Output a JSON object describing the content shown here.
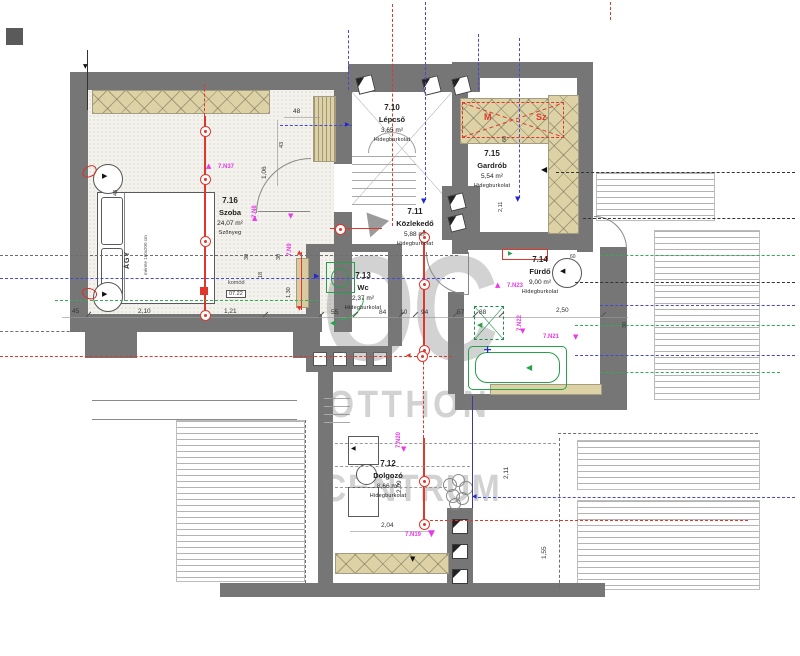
{
  "rooms": [
    {
      "num": "7.10",
      "name": "Lépcső",
      "area": "3,65 m²",
      "floor": "Hidegburkolat"
    },
    {
      "num": "7.11",
      "name": "Közlekedő",
      "area": "5,88 m²",
      "floor": "Hidegburkolat"
    },
    {
      "num": "7.12",
      "name": "Dolgozó",
      "area": "8,66 m²",
      "floor": "Hidegburkolat"
    },
    {
      "num": "7.13",
      "name": "Wc",
      "area": "2,37 m²",
      "floor": "Hidegburkolat"
    },
    {
      "num": "7.14",
      "name": "Fürdő",
      "area": "9,00 m²",
      "floor": "Hidegburkolat"
    },
    {
      "num": "7.15",
      "name": "Gardrób",
      "area": "5,54 m²",
      "floor": "Hidegburkolat"
    },
    {
      "num": "7.16",
      "name": "Szoba",
      "area": "24,07 m²",
      "floor": "Szőnyeg"
    }
  ],
  "furniture": {
    "bed": "ÁGY",
    "bed_size": "mérete 160x200 cm",
    "komod": "komód",
    "komod_code": "07.22"
  },
  "flags": {
    "m": "M",
    "sz": "Sz"
  },
  "markers": [
    "7.N37",
    "7.N8",
    "7.N9",
    "7.N23",
    "7.N22",
    "7.N21",
    "7.N20",
    "7.N19"
  ],
  "dims": [
    "48",
    "1,06",
    "43",
    "43",
    "45",
    "2,10",
    "1,21",
    "30",
    "30",
    "18",
    "1,30",
    "55",
    "84",
    "10",
    "94",
    "57",
    "88",
    "2,50",
    "30",
    "60",
    "60",
    "2,04",
    "2,09",
    "2,11",
    "1,55",
    "2,11"
  ],
  "watermark": {
    "line1": "OC",
    "line2": "OTTHON",
    "line3": "CENTRUM"
  },
  "icons": {
    "tri_up": "▲",
    "tri_down": "▼",
    "tri_left": "◀",
    "tri_right": "▶",
    "plus": "+"
  }
}
